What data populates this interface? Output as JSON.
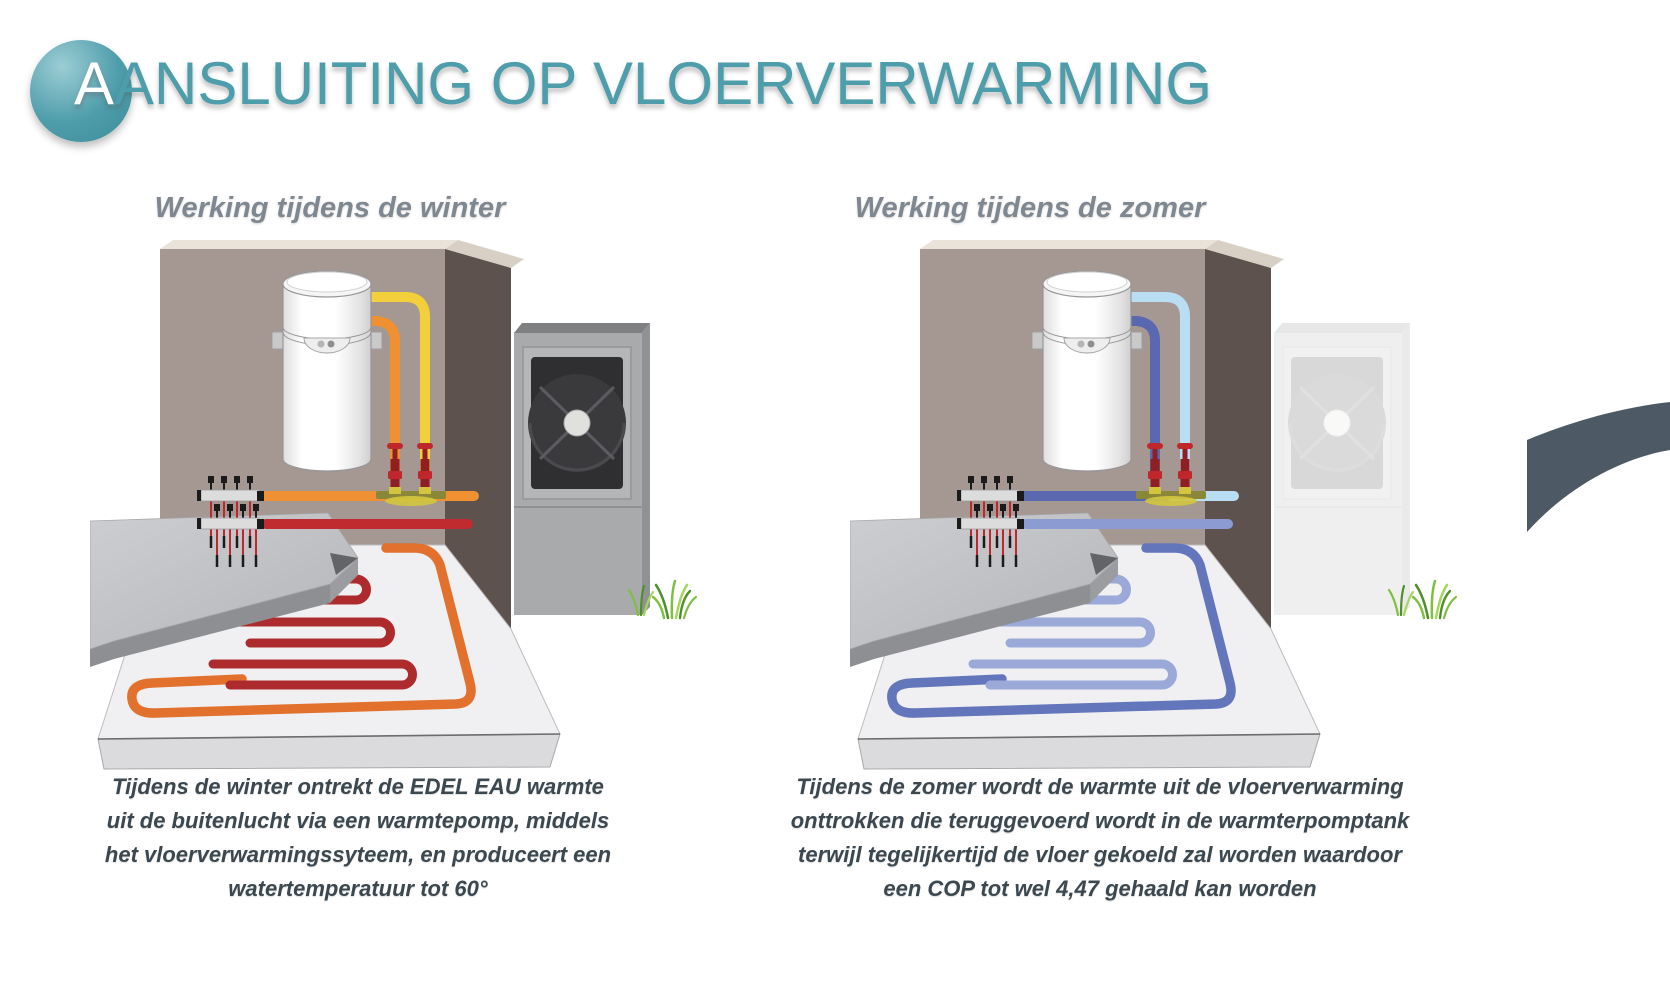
{
  "header": {
    "title_initial": "A",
    "title_rest": "ANSLUITING OP VLOERVERWARMING"
  },
  "theme": {
    "title_color": "#4e9dab",
    "accent": "#4e9dab",
    "accent_light": "#9ccdd4",
    "accent_dark": "#3e8c99",
    "heading_color": "#7f8790",
    "caption_color": "#3c4850",
    "swoosh_color": "#4d5965",
    "background": "#ffffff"
  },
  "figures": [
    {
      "id": "winter",
      "heading": "Werking tijdens de winter",
      "caption": "Tijdens de winter ontrekt de EDEL EAU warmte\nuit de buitenlucht via een warmtepomp, middels\nhet vloerverwarmingssyteem, en produceert een\nwatertemperatuur tot 60°",
      "heat_pump_ghosted": false,
      "colors": {
        "pipe_vertical_outer": "#f2cf3b",
        "pipe_vertical_inner": "#ef9133",
        "pipe_horizontal_left": "#ef9133",
        "pipe_horizontal_right": "#ef9133",
        "pipe_return": "#bf2b2e",
        "floor_loop_outer": "#e2712d",
        "floor_loop_inner": "#ae2b2d"
      }
    },
    {
      "id": "zomer",
      "heading": "Werking tijdens de zomer",
      "caption": "Tijdens de zomer wordt de warmte uit de vloerverwarming\nonttrokken die teruggevoerd wordt in de warmterpomptank\nterwijl tegelijkertijd de vloer gekoeld zal worden waardoor\neen COP tot wel 4,47 gehaald kan worden",
      "heat_pump_ghosted": true,
      "colors": {
        "pipe_vertical_outer": "#b9ddf2",
        "pipe_vertical_inner": "#5a68b0",
        "pipe_horizontal_left": "#5a68b0",
        "pipe_horizontal_right": "#b9ddf2",
        "pipe_return": "#8c9cd2",
        "floor_loop_outer": "#6476bb",
        "floor_loop_inner": "#9aa9d8"
      }
    }
  ],
  "scene": {
    "wall": "#a59792",
    "wall_side": "#5d524e",
    "wall_top": "#eae3da",
    "wall_top_wedge": "#d8d0c4",
    "floor": "#f0f0f2",
    "floor_edge": "#dbdbdd",
    "slab_top_light": "#cdced1",
    "slab_top_dark": "#b4b5b8",
    "slab_front": "#8e8f93",
    "slab_side": "#9b9c9f",
    "slab_notch": "#636468",
    "tank_outline": "#97979a",
    "unit_front": "#a9aaac",
    "unit_top": "#7f8082",
    "unit_side": "#909194",
    "unit_panel": "#b5b6b8",
    "fan_dark": "#3a3a3d",
    "fan_hub": "#e0e1dd",
    "manifold_bar": "#dcdcdd",
    "pin_black": "#1b1b1b",
    "pin_red": "#c0272d",
    "valve_red": "#c0272d",
    "valve_dark": "#8f1f23",
    "brass": "#8a8838",
    "brass_light": "#d3c63e",
    "grass": [
      "#7fbf3f",
      "#4f9129",
      "#a5d75f"
    ]
  }
}
